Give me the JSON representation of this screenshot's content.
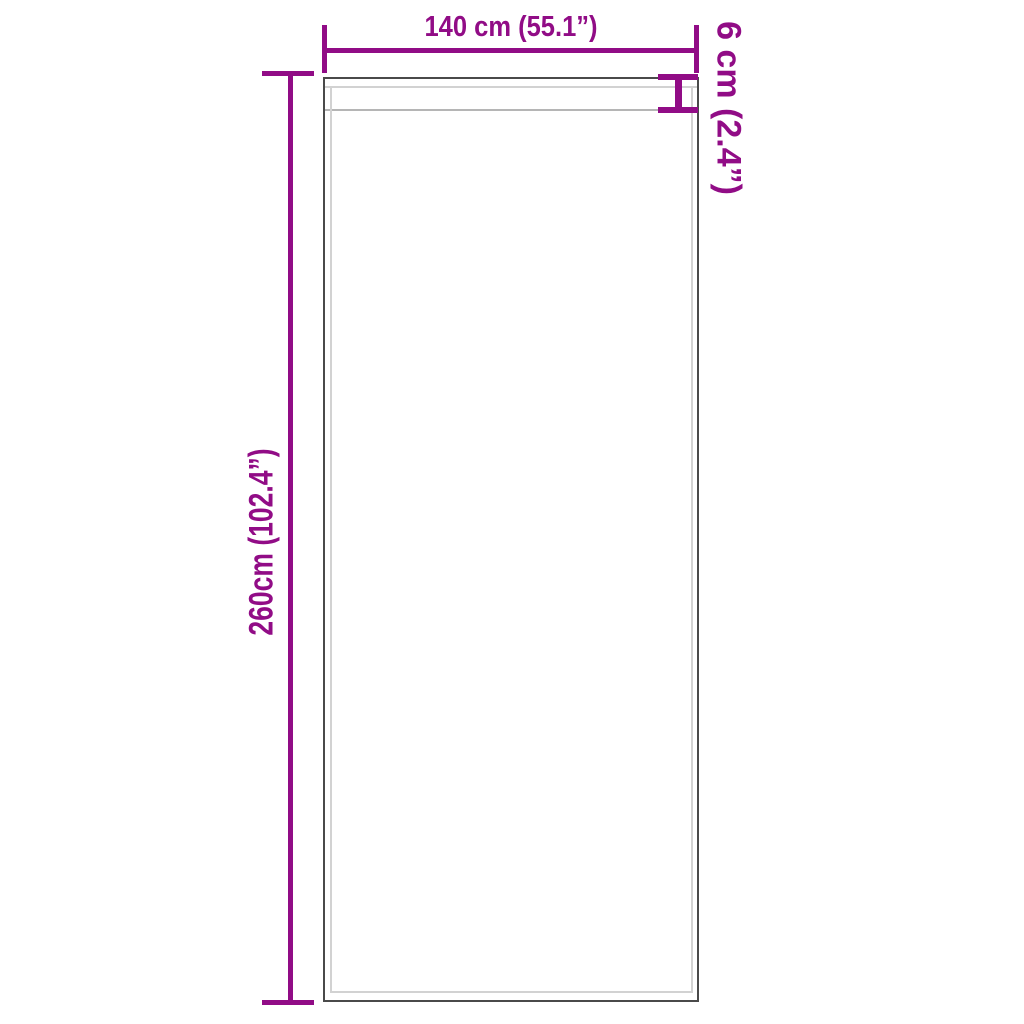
{
  "diagram": {
    "type": "product-dimension-diagram",
    "product": "curtain-panel",
    "labels": {
      "width": "140 cm (55.1”)",
      "header": "6 cm (2.4”)",
      "height": "260cm (102.4”)"
    },
    "dimensions": {
      "width_cm": 140,
      "width_in": 55.1,
      "header_cm": 6,
      "header_in": 2.4,
      "height_cm": 260,
      "height_in": 102.4
    },
    "colors": {
      "accent": "#910c86",
      "outline": "#4a4a4a",
      "seam_light": "#d2d2d2",
      "seam_dark": "#b5b5b5",
      "background": "#ffffff"
    }
  }
}
